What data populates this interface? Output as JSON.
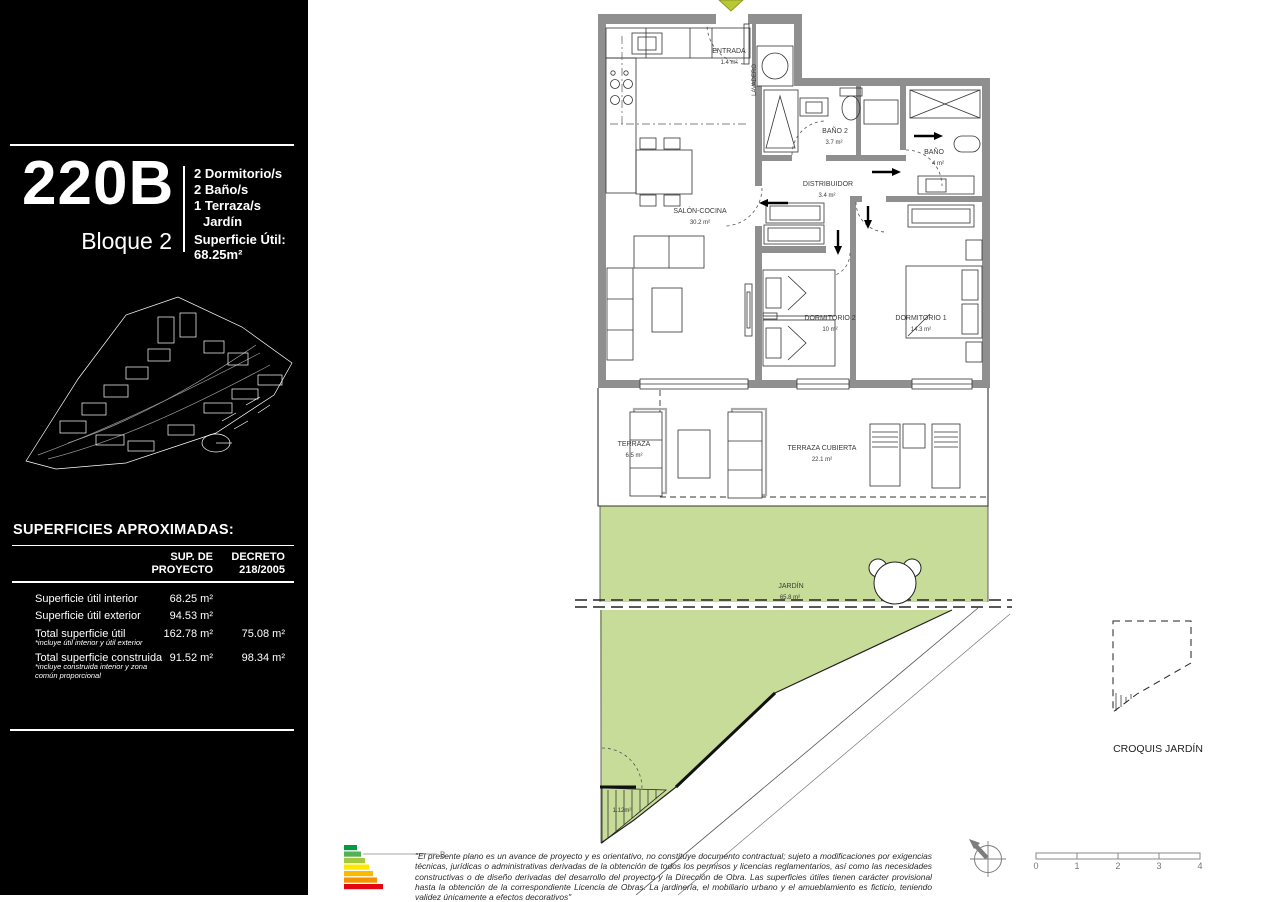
{
  "document": {
    "unit_code": "220B",
    "block": "Bloque 2",
    "features": [
      "2 Dormitorio/s",
      "2 Baño/s",
      "1 Terraza/s",
      "Jardín"
    ],
    "superficie_util_label": "Superficie Útil:",
    "superficie_util_value": "68.25m²"
  },
  "areas_table": {
    "title": "SUPERFICIES APROXIMADAS:",
    "col1_header": "SUP. DE\nPROYECTO",
    "col2_header": "DECRETO\n218/2005",
    "rows": [
      {
        "label": "Superficie útil interior",
        "note": "",
        "v1": "68.25 m²",
        "v2": ""
      },
      {
        "label": "Superficie útil exterior",
        "note": "",
        "v1": "94.53 m²",
        "v2": ""
      },
      {
        "label": "Total superficie útil",
        "note": "*incluye útil interior y útil exterior",
        "v1": "162.78 m²",
        "v2": "75.08 m²"
      },
      {
        "label": "Total superficie construida",
        "note": "*incluye construida interior y zona común proporcional",
        "v1": "91.52 m²",
        "v2": "98.34 m²"
      }
    ]
  },
  "floor_plan": {
    "rooms": {
      "entrada": {
        "name": "ENTRADA",
        "area": "1.4 m²"
      },
      "salon_cocina": {
        "name": "SALÓN-COCINA",
        "area": "30.2 m²"
      },
      "bano2": {
        "name": "BAÑO 2",
        "area": "3.7 m²"
      },
      "distribuidor": {
        "name": "DISTRIBUIDOR",
        "area": "3.4 m²"
      },
      "bano": {
        "name": "BAÑO",
        "area": "4 m²"
      },
      "dormitorio2": {
        "name": "DORMITORIO 2",
        "area": "10 m²"
      },
      "dormitorio1": {
        "name": "DORMITORIO 1",
        "area": "14.3 m²"
      },
      "terraza": {
        "name": "TERRAZA",
        "area": "6.5 m²"
      },
      "terraza_cubierta": {
        "name": "TERRAZA CUBIERTA",
        "area": "22.1 m²"
      },
      "jardin": {
        "name": "JARDÍN",
        "area": "65.8 m²"
      },
      "lavadero": {
        "name": "LAVADERO"
      }
    },
    "garden_patch_area": "1.12m²",
    "croquis_label": "CROQUIS JARDÍN"
  },
  "footer": {
    "disclaimer": "\"El presente plano es un avance de proyecto y es orientativo, no constituye documento contractual; sujeto a modificaciones por exigencias técnicas, jurídicas o administrativas derivadas de la obtención de todos los permisos y licencias reglamentarios, así como las necesidades constructivas o de diseño derivadas del desarrollo del proyecto y la Dirección de Obra. Las superficies útiles tienen carácter provisional hasta la obtención de la correspondiente Licencia de Obras. La jardinería, el mobiliario urbano y el amueblamiento es ficticio, teniendo validez únicamente a efectos decorativos\"",
    "energy_rating": "B",
    "scale_ticks": [
      "0",
      "1",
      "2",
      "3",
      "4"
    ]
  },
  "colors": {
    "garden_green": "#c7dc98",
    "wall_gray": "#8f8f8f",
    "entrance_arrow": "#b9c832",
    "energy_colors": [
      "#009a44",
      "#52b153",
      "#a5c93c",
      "#ffe800",
      "#fbba00",
      "#f39200",
      "#e30613"
    ]
  }
}
